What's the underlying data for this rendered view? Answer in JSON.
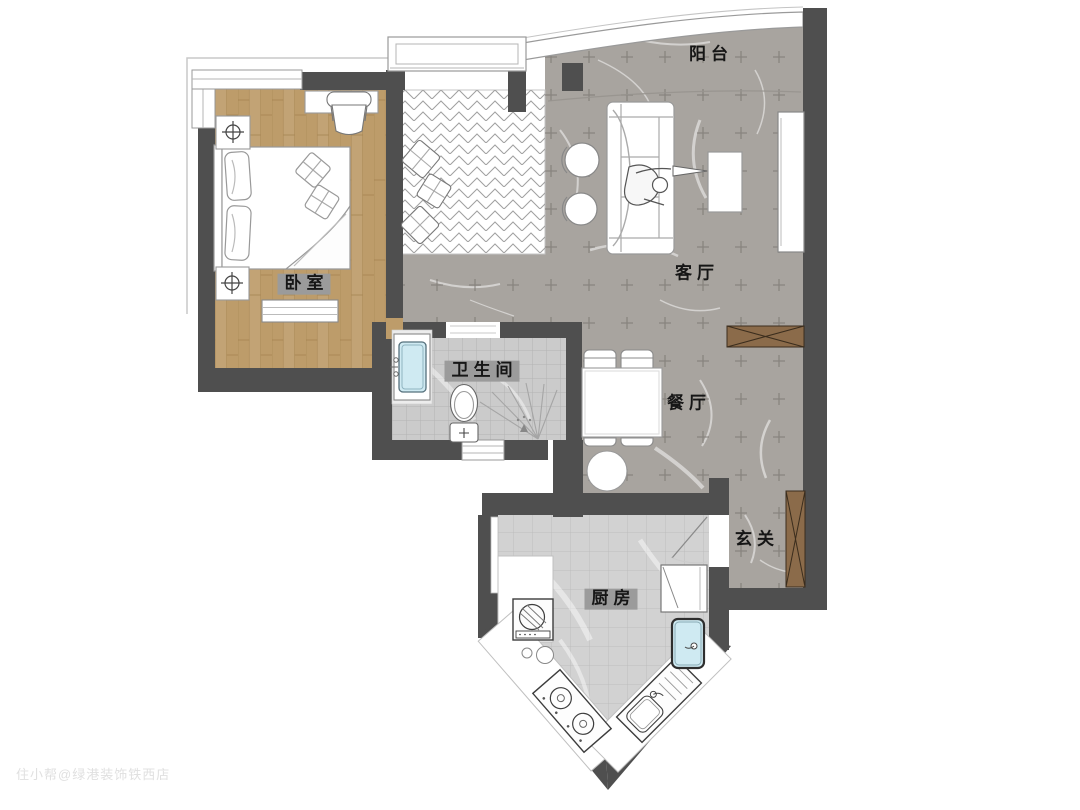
{
  "plan": {
    "rooms": [
      {
        "id": "balcony",
        "label": "阳台"
      },
      {
        "id": "living",
        "label": "客厅"
      },
      {
        "id": "bedroom",
        "label": "卧室"
      },
      {
        "id": "bathroom",
        "label": "卫生间"
      },
      {
        "id": "dining",
        "label": "餐厅"
      },
      {
        "id": "entry",
        "label": "玄关"
      },
      {
        "id": "kitchen",
        "label": "厨房"
      }
    ],
    "watermark": "住小帮@绿港装饰铁西店",
    "colors": {
      "wall": "#4f4f4f",
      "wood": "#bd9c6a",
      "marble": "#a8a49f",
      "ktile": "#d2d2d2",
      "btile": "#cbcbcb",
      "cabwood": "#8b6b4a",
      "sinkblue": "#cfeaf2",
      "badge": "#9b9b9b"
    }
  }
}
